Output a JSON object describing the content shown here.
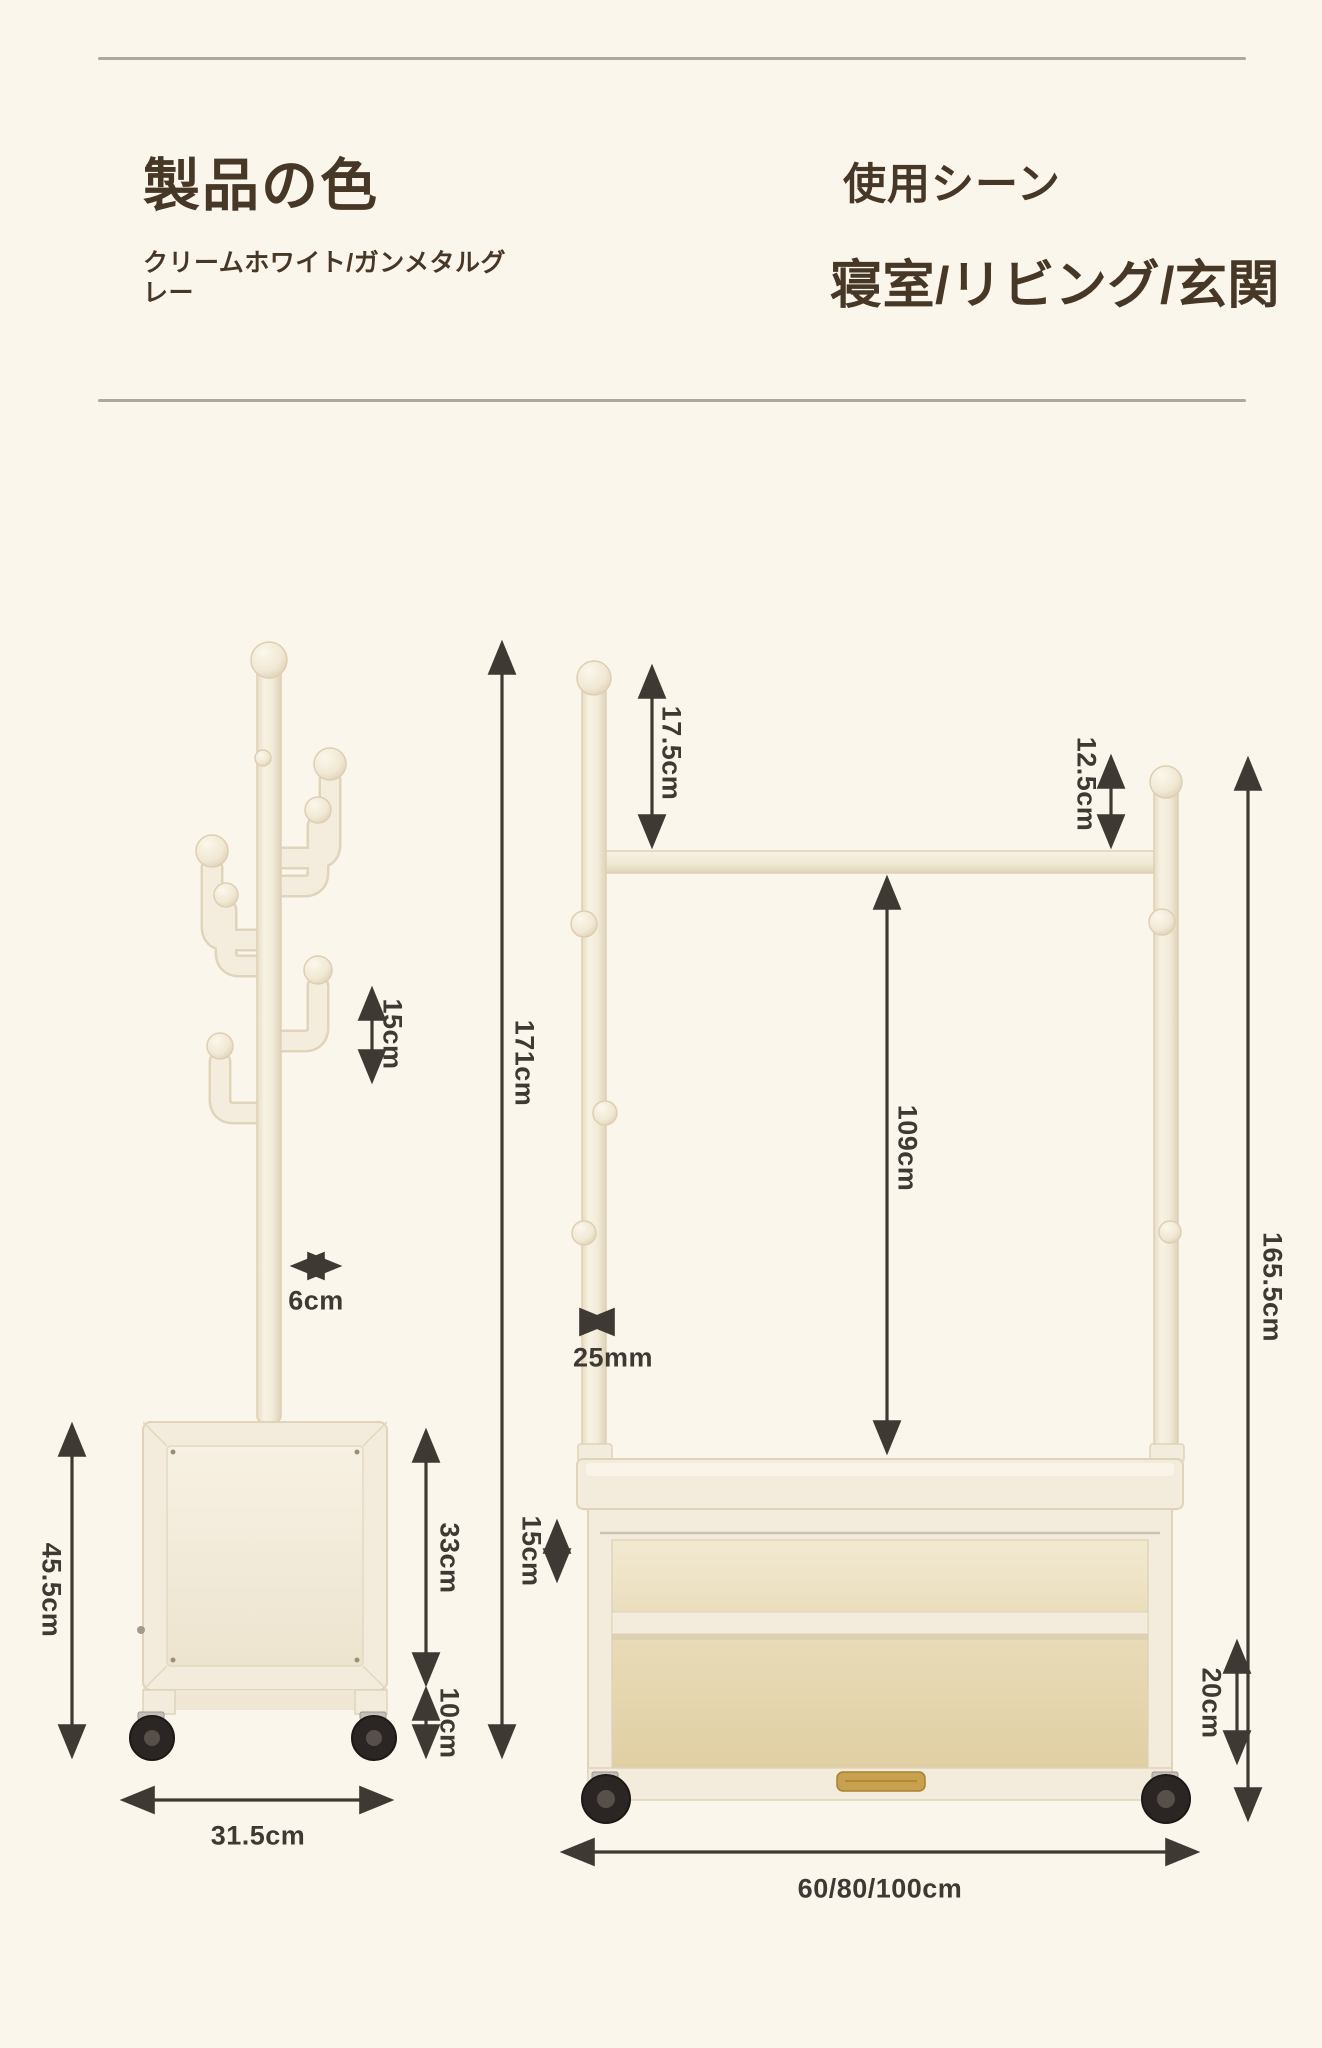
{
  "page": {
    "background": "#FBF6EC",
    "divider_color": "#ACA9A3",
    "heading_color": "#473726",
    "dimension_color": "#3E3933"
  },
  "header": {
    "product_color": {
      "title": "製品の色",
      "value": "クリームホワイト/ガンメタルグレー"
    },
    "usage_scene": {
      "title": "使用シーン",
      "value": "寝室/リビング/玄関"
    }
  },
  "colors": {
    "product_fill": "#F3ECDC",
    "product_outline": "#E0D4BA",
    "interior_wood": "#E7D6B0",
    "handle_gold": "#C7A050",
    "wheel_black": "#2B2623"
  },
  "left_stand": {
    "label": "coat-stand-with-cabinet",
    "dimensions": {
      "hook_height": "15cm",
      "hook_depth": "6cm",
      "total_height": "171cm",
      "base_height": "45.5cm",
      "cabinet_height": "33cm",
      "clearance": "10cm",
      "base_width": "31.5cm"
    }
  },
  "hanger_rack": {
    "label": "hanger-rack-with-shelf-cabinet",
    "dimensions": {
      "pole_above_rail": "17.5cm",
      "knob_above_rail": "12.5cm",
      "rail_to_shelf": "109cm",
      "total_height": "165.5cm",
      "pole_diameter": "25mm",
      "top_gap": "15cm",
      "shelf_height": "20cm",
      "width_options": "60/80/100cm"
    }
  }
}
